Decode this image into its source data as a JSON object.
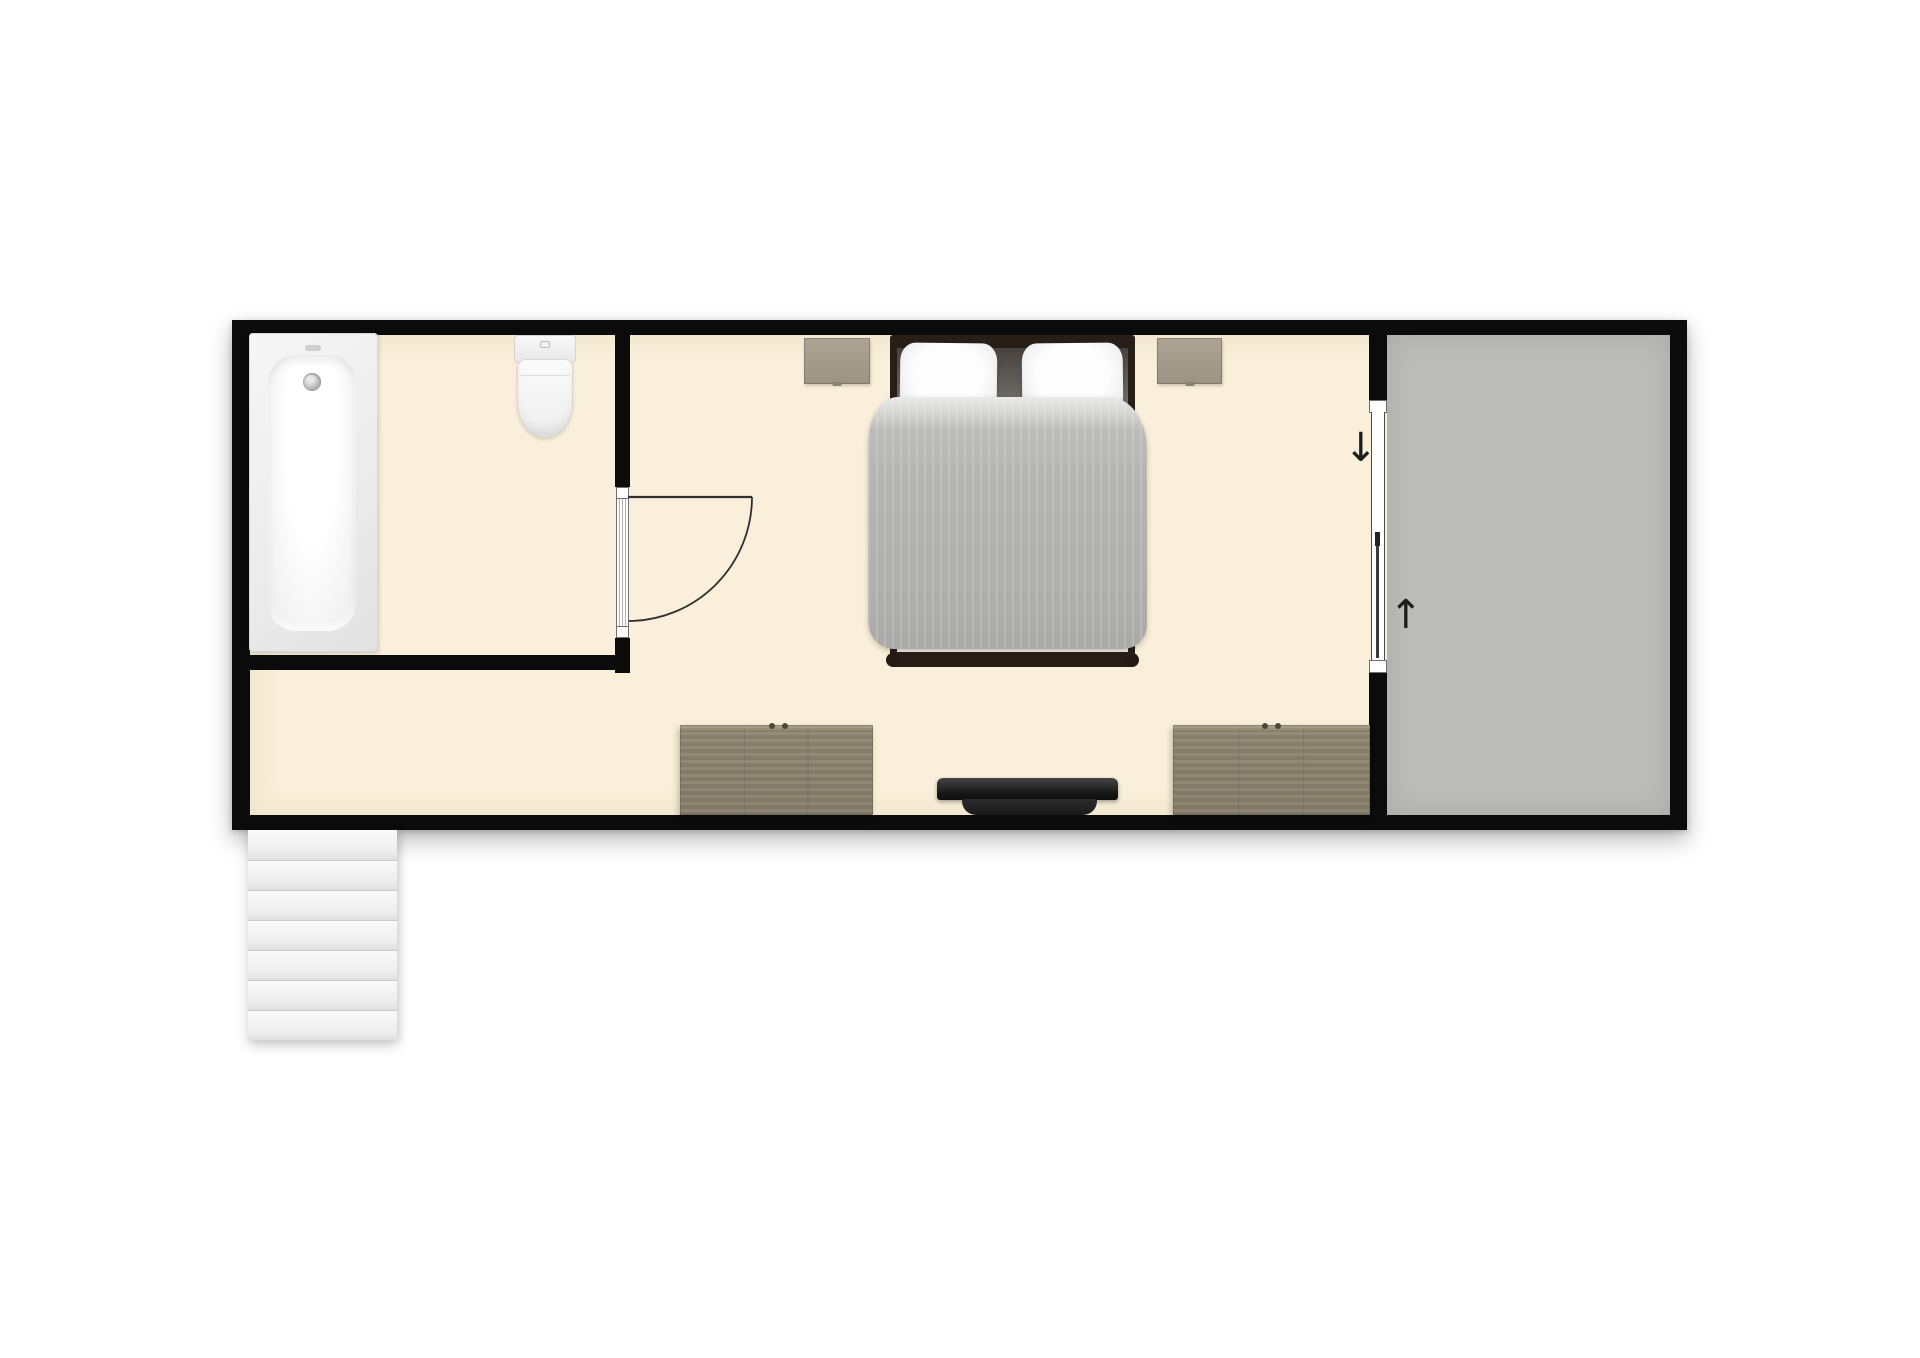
{
  "canvas": {
    "width": 1920,
    "height": 1358,
    "background": "#ffffff"
  },
  "palette": {
    "wall": "#0b0b0b",
    "room_floor": "#f9efda",
    "terrace_floor": "#bcbcba",
    "fixture_white": "#f5f5f5",
    "bed_frame": "#271e18",
    "duvet_gray": "#b3b3b1",
    "pillow_white": "#f3f3f3",
    "nightstand_wood": "#a59c8c",
    "dresser_wood": "#8f8672",
    "tv_black": "#1d1d1d",
    "stair_white": "#f2f2f2",
    "door_line": "#2f2f2f"
  },
  "floorplan": {
    "type": "apartment-floor-plan",
    "rooms": [
      {
        "id": "bathroom",
        "furniture": [
          "bathtub",
          "toilet"
        ]
      },
      {
        "id": "bedroom",
        "furniture": [
          "double-bed",
          "pillow-left",
          "pillow-right",
          "nightstand-left",
          "nightstand-right",
          "dresser-left",
          "dresser-right",
          "tv"
        ]
      },
      {
        "id": "terrace",
        "furniture": []
      }
    ],
    "doors": [
      {
        "id": "bathroom-door",
        "type": "hinged",
        "state": "open-90deg",
        "swing": "into-bedroom"
      },
      {
        "id": "terrace-sliding-door",
        "type": "sliding",
        "panels": 2
      }
    ],
    "stairs": {
      "treads": 7,
      "location": "bottom-left-exterior"
    },
    "annotations": {
      "slide_down_arrow": "↓",
      "slide_up_arrow": "↑"
    }
  }
}
